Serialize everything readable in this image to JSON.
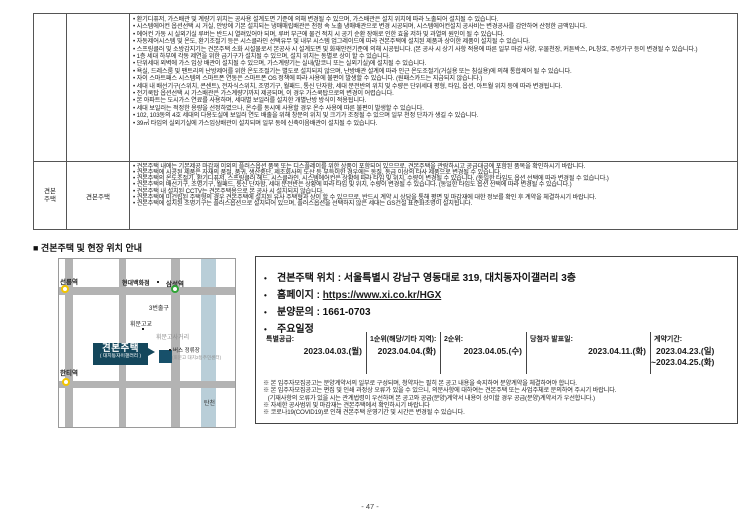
{
  "page": {
    "number": "- 47 -"
  },
  "colors": {
    "callout_bg": "#14475c",
    "site_square": "#17506a",
    "road": "#b3b3b3",
    "river": "#b9ced8",
    "station_yellow": "#f2c500",
    "station_green": "#2fa535"
  },
  "table": {
    "row1": {
      "group_label": "",
      "sub_label": "",
      "bullets": [
        "환기디퓨저, 가스배관 및 계량기 위치는 공사용 설계도면 기준에 의해 변경될 수 있으며, 가스배관은 설치 위치에 따라 노출되어 설치될 수 있습니다.",
        "시스템에어컨 옵션선택 시 거실, 안방에 기본 설치되는 냉매매립배관은 천정 속 노출 냉매배관으로 변경 시공되며, 시스템에어컨설치 공사비는 변경공사를 감안하여 산정한 금액입니다.",
        "에어컨 가동 시 실외기실 루버는 반드시 열려있어야 되며, 루버 부근에 물건 적치 시 공기 순환 장애로 인한 효율 저하 및 과열의 원인이 될 수 있습니다.",
        "자동제어시스템 및 온도, 환기조절기 등은 시스클라인 선택유무 및 내부 시스템 업그레이드에 따라 견본주택에 설치된 제품과 상이한 제품이 설치될 수 있습니다.",
        "스프링클러 및 소방감지기는 견본주택 소화 시설물로서 본공사 시 설계도면 및 화재안전기준에 의해 시공됩니다. (본 공사 시 상기 사항 적용에 따른 일부 마감 사양, 우물천장, 커튼박스, PL창호, 주방가구 등이 변경될 수 있습니다.)",
        "1층 세대 하부에 각동 제연을 위한 급기구가 설치될 수 있으며, 설치 위치는 동별로 상이 할 수 있습니다.",
        "단위세대 외벽에 가스 입상 배관이 설치될 수 있으며, 가스계량기는 실내(발코니 또는 실외기실)에 설치될 수 있습니다.",
        "욕실, 드레스룸 및 팬트리의 난방제어를 위한 온도조절기는 별도로 설치되지 않으며, 난방배관 설계에 따라 인근 온도조절기(거실용 또는 침실용)에 의해 통합제어 될 수 있습니다.",
        "자이 스마트패스 시스템의 스마트폰 연동은 스마트폰 OS 정책에 따라 사용에 불편이 발생할 수 있습니다. (원패스카드는 지급되지 않습니다.)",
        "세대 내 배선기구(스위치, 콘센트), 전자식스위치, 조명기구, 월패드, 통신 단자함, 세대 분전반의 위치 및 수량은 단위세대 평형, 타입, 옵션, 아트월 위치 등에 따라 변경됩니다.",
        "전기쿡탑 옵션선택 시 가스배관은 가스계량기까지 제공되며, 이 경우 가스쿡탑으로의 변경이 어렵습니다.",
        "본 아파트는 도시가스 연료를 사용하며, 세대별 보일러를 설치한 개별난방 방식이 적용됩니다.",
        "세대 보일러는 적정한 용량을 선정하였으나, 온수를 동시에 사용할 경우 온수 사용에 따른 불편이 발생할 수 있습니다.",
        "102, 103동의 4호 세대의 다용도실에 보일러 연도 배출을 위해 창문의 위치 및 크기가 조정될 수 있으며 일부 천정 단차가 생길 수 있습니다.",
        "39㎡ 타입의 실외기실에 가스입상배관이 설치되며 일부 동에 신축이음배관이 설치될 수 있습니다."
      ]
    },
    "row2": {
      "group_label": "견본주택",
      "sub_label": "견본주택",
      "bullets": [
        "견본주택 내에는 기본제공 마감재 이외의 플러스옵션 품목 또는 디스플레이를 위한 상품이 포함되어 있으므로, 견본주택을 관람하시고 공급대금에 포함된 품목을 확인하시기 바랍니다.",
        "견본주택에 시공된 제품은 자재의 품절, 품귀, 생산중단, 제조회사의 도산 등 부득이한 경우에는 동질, 동급 이상의 타사 제품으로 변경될 수 있습니다.",
        "견본주택의 온도조절기, 환기디퓨저, 스프링클러 헤드, 시스클라인, 시스템에어컨은 상황에 따라 타입 및 위치, 수량이 변경될 수 있습니다. (동일한 타입도 옵션 선택에 따라 변경될 수 있습니다.)",
        "견본주택의 배선기구, 조명기구, 월패드, 통신 단자함, 세대 분전반은 상황에 따라 타입 및 위치, 수량이 변경될 수 있습니다. (동일한 타입도 옵션 선택에 따라 변경될 수 있습니다.)",
        "견본주택 내 설치된 CCTV는 견본주택용으로 본 공사 시 설치되지 않습니다.",
        "견본주택에 미건립된 주택형의 경우 견본주택에 설치된 유사 주택형과 상이 할 수 있으므로, 반드시 계약 시 상담을 통해 평면 및 마감재에 대한 정보를 확인 후 계약을 체결하시기 바랍니다.",
        "견본주택에 설치된 조명기구는 플러스옵션으로 설치되어 있으며, 플러스옵션을 선택하지 않은 세대는 GS건설 표준화조명이 설치됩니다."
      ]
    }
  },
  "section": {
    "heading": "■ 견본주택 및 현장 위치 안내"
  },
  "info": {
    "location": "견본주택 위치 : 서울특별시 강남구 영동대로 319, 대치동자이갤러리 3층",
    "homepage_label": "홈페이지 :",
    "homepage_url": "https://www.xi.co.kr/HGX",
    "phone": "분양문의 : 1661-0703",
    "schedule_label": "주요일정"
  },
  "schedule": {
    "cols": [
      {
        "label": "특별공급:",
        "date1": "2023.04.03.(월)",
        "date2": ""
      },
      {
        "label": "1순위(해당/기타 지역):",
        "date1": "2023.04.04.(화)",
        "date2": ""
      },
      {
        "label": "2순위:",
        "date1": "2023.04.05.(수)",
        "date2": ""
      },
      {
        "label": "당첨자 발표일:",
        "date1": "2023.04.11.(화)",
        "date2": ""
      },
      {
        "label": "계약기간:",
        "date1": "2023.04.23.(일)",
        "date2": "~2023.04.25.(화)"
      }
    ]
  },
  "footnotes": [
    "※ 본 입주자모집공고는 분양계약서의 일부로 구성되며, 청약자는 필히 본 공고 내용을 숙지하여 분양계약을 체결하여야 합니다.",
    "※ 본 입주자모집공고는 편집 및 인쇄 과정상 오류가 있을 수 있으니, 의문사항에 대하여는 견본주택 또는 사업주체로 문의하여 주시기 바랍니다.",
    "   (기재사항의 오류가 있을 시는 관계법령이 우선하며 본 공고와 공급(분양)계약서 내용이 상이할 경우 공급(분양)계약서가 우선합니다.)",
    "※ 자세한 공사범위 및 마감재는 견본주택에서 확인하시기 바랍니다",
    "※ 코로나19(COVID19)로 인해 견본주택 운영기간 및 시간은 변경될 수 있습니다."
  ],
  "map": {
    "labels": {
      "seolleung": "선릉역",
      "hyundai_dept": "현대백화점",
      "samseong": "삼성역",
      "exit3": "3번출구",
      "whimoon_school": "휘문고교",
      "whimoon_crossing": "휘문고사거리",
      "bus_stop": "버스 정류장",
      "bus_stop_sub": "(휘문고 대치2동주민센터)",
      "hanti": "한티역",
      "tancheon": "탄천",
      "callout_title": "견본주택",
      "callout_sub": "( 대치동자이갤러리 )"
    }
  }
}
